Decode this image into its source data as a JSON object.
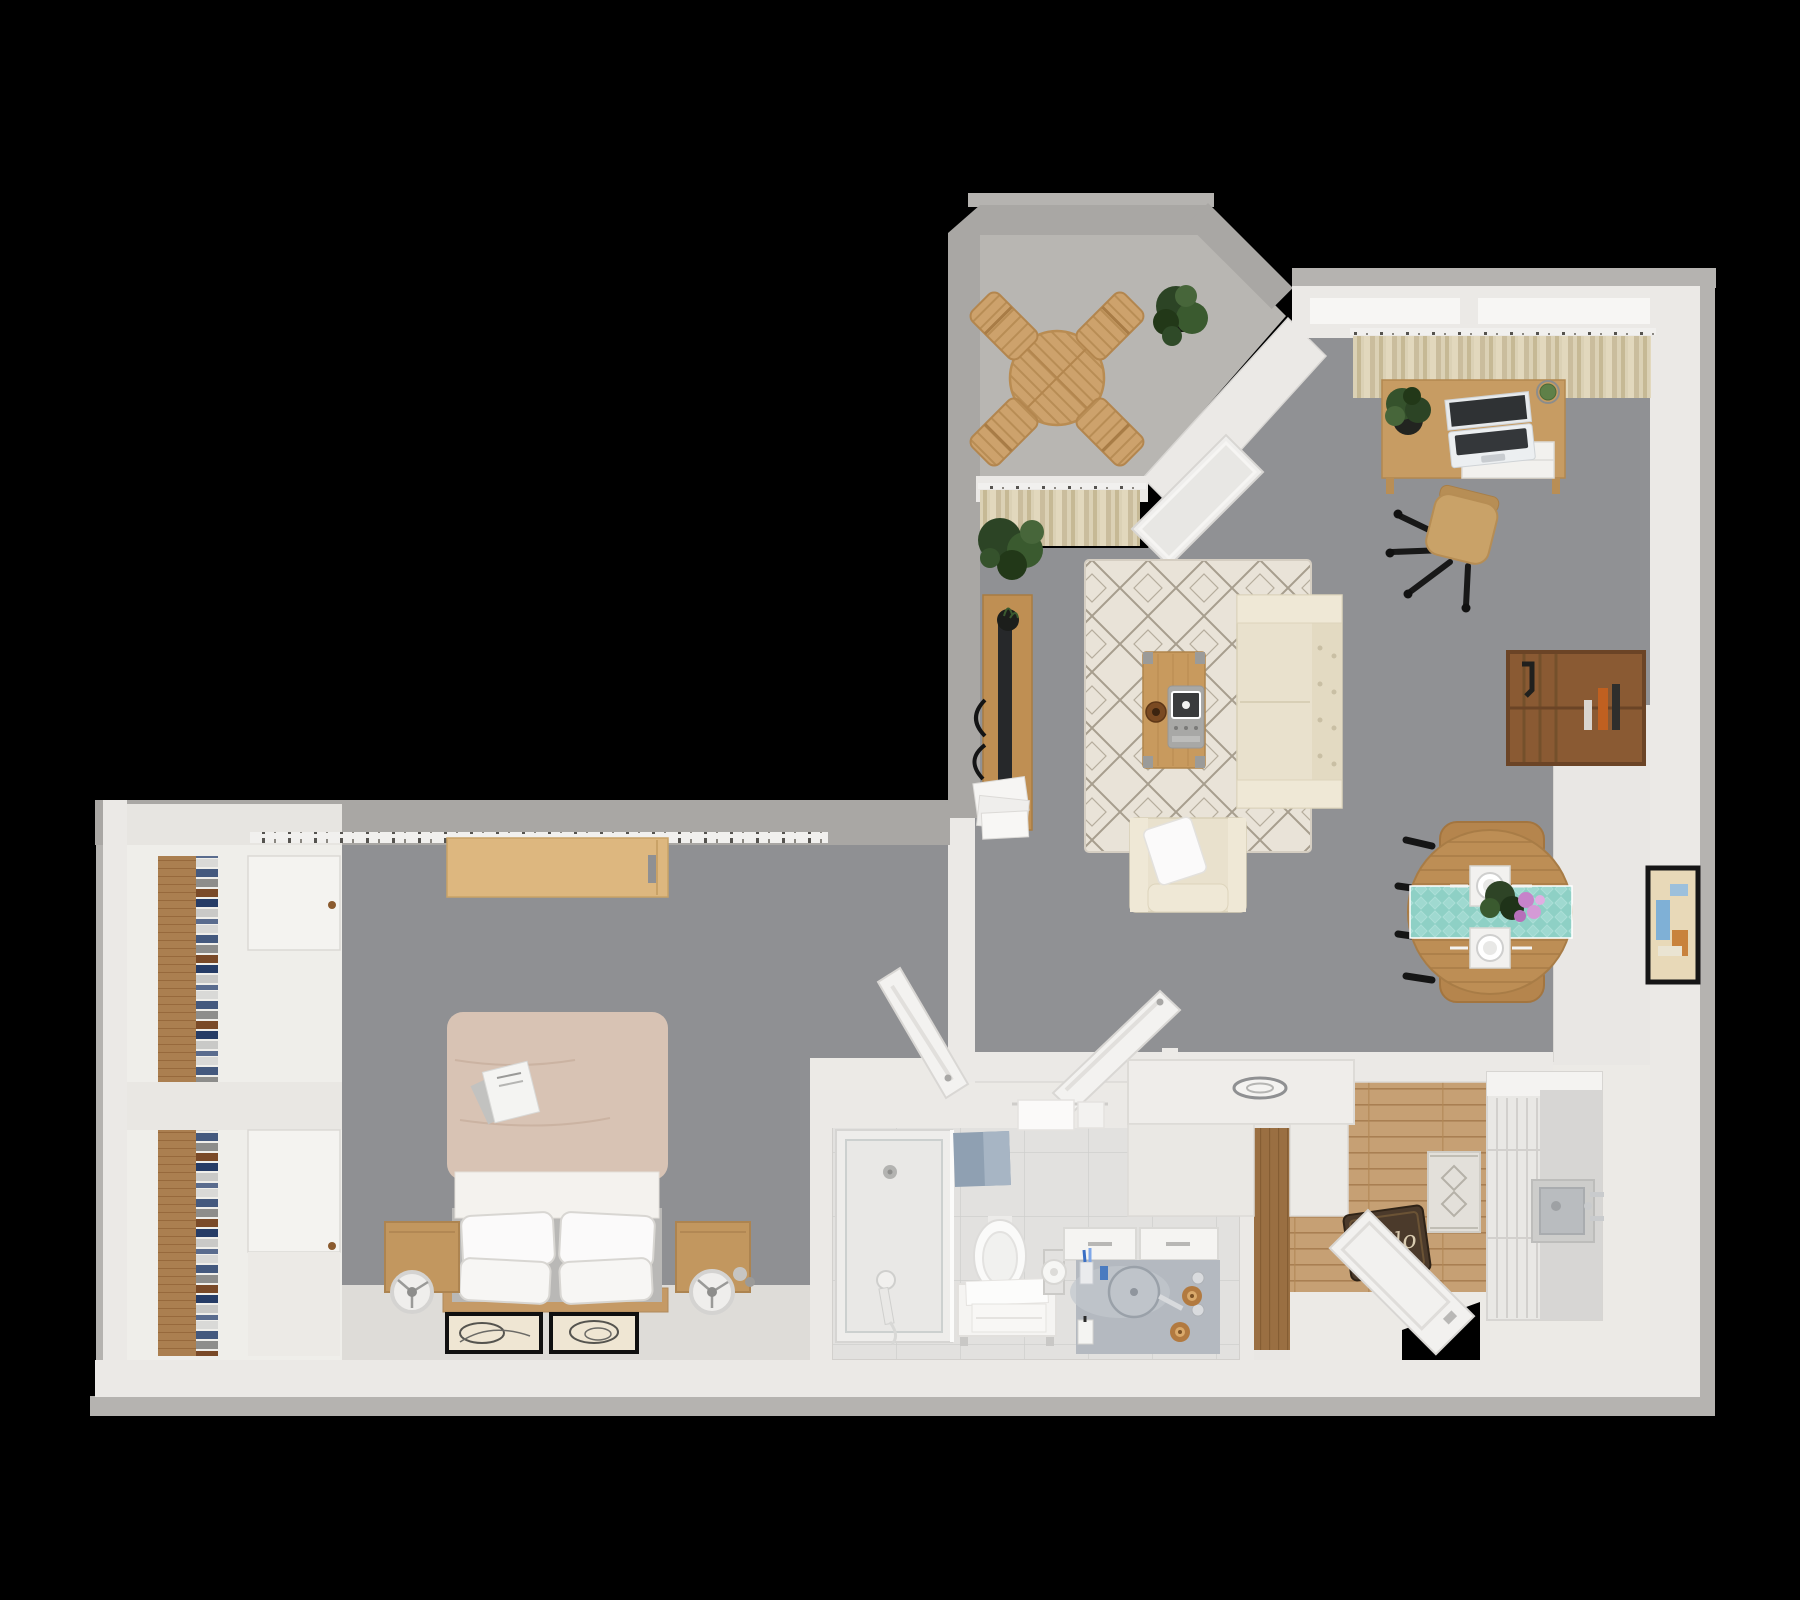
{
  "scene": {
    "description": "3D top-down floor plan render of a one-bedroom apartment on a black background",
    "background": "#000000"
  },
  "doormat": {
    "text": "hello"
  },
  "palette": {
    "wall_white": "#ebe9e6",
    "wall_concrete": "#a9a7a4",
    "outer_shadow": "#b5b3b0",
    "floor_gray": "#8f9093",
    "bedroom_light_floor": "#dedcd8",
    "balcony_floor": "#b8b6b2",
    "wood_light": "#c59e6b",
    "wood_mid": "#ab7f50",
    "wood_dark": "#8a5a33",
    "rug_cream": "#e9e3d8",
    "sofa_cream": "#e9e1cd",
    "curtain_beige": "#d9cdae",
    "tile_light": "#e2e1df",
    "runner_teal": "#8ed0c5",
    "bath_mat_blue": "#8fa0b2",
    "doormat_brown": "#4b3a2b",
    "plant_green": "#3a5a2f",
    "tv_black": "#26282a"
  },
  "rooms": {
    "balcony": {
      "label": "balcony",
      "furniture": [
        "round-slatted-table",
        "four-folding-chairs",
        "potted-plant"
      ]
    },
    "living_room": {
      "label": "living-room",
      "furniture": [
        "desk-with-laptop",
        "office-chair",
        "window-curtains",
        "sectional-sofa",
        "armchair-with-pillow",
        "area-rug",
        "coffee-table",
        "tv-console-with-tv",
        "floor-plant",
        "wall-bookshelf",
        "round-dining-table",
        "dining-chairs",
        "wall-art-frame",
        "open-balcony-door"
      ]
    },
    "bedroom": {
      "label": "bedroom",
      "furniture": [
        "double-bed",
        "nightstands",
        "round-lamps",
        "wardrobes",
        "book-shelf-columns",
        "wall-desk",
        "curtain-rail",
        "leaning-art-frames",
        "book-on-bed"
      ]
    },
    "bathroom": {
      "label": "bathroom",
      "furniture": [
        "walk-in-shower",
        "toilet",
        "towel-bench",
        "vanity-with-sink",
        "bath-mat",
        "towel-rail",
        "toilet-paper-holder"
      ]
    },
    "kitchen": {
      "label": "kitchen-entry",
      "furniture": [
        "counter-peninsula",
        "tall-cabinet-with-sink",
        "runner-rug",
        "welcome-doormat",
        "open-entry-door",
        "hall-wood-cabinet"
      ]
    }
  }
}
